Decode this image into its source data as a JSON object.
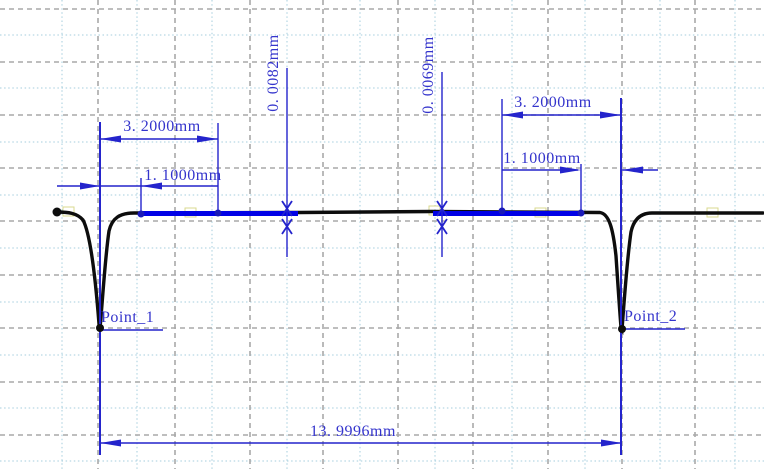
{
  "chart_data": {
    "type": "line",
    "title": "",
    "units": "mm",
    "description": "Surface profile trace (profilometer result view) with two narrow V-grooves on a flat surface, annotated with CAD-style dimensions",
    "profile": {
      "points": [
        {
          "label": "Point_1"
        },
        {
          "label": "Point_2"
        }
      ],
      "flat_level_note": "profile is flat between and outside the two grooves; grooves are narrow deep V shapes",
      "distance_between_points_mm": 13.9996
    },
    "measurements": {
      "left_width": {
        "label": "3. 2000mm",
        "value_mm": 3.2
      },
      "left_inner_width": {
        "label": "1. 1000mm",
        "value_mm": 1.1
      },
      "left_step_height": {
        "label": "0. 0082mm",
        "value_mm": 0.0082
      },
      "right_step_height": {
        "label": "0. 0069mm",
        "value_mm": 0.0069
      },
      "right_width": {
        "label": "3. 2000mm",
        "value_mm": 3.2
      },
      "right_inner_width": {
        "label": "1. 1000mm",
        "value_mm": 1.1
      },
      "total_width": {
        "label": "13. 9996mm",
        "value_mm": 13.9996
      }
    },
    "legend": null,
    "grid": "on (alternating gray dashed major lines and light-blue dotted minor lines)",
    "colors": {
      "dimension_blue": "#2424cc",
      "reference_line_blue": "#0101e6",
      "profile_black": "#0d0d0d",
      "grid_major_gray": "#a9a9a9",
      "grid_minor_lightblue": "#a5cede",
      "background": "#ffffff"
    }
  }
}
